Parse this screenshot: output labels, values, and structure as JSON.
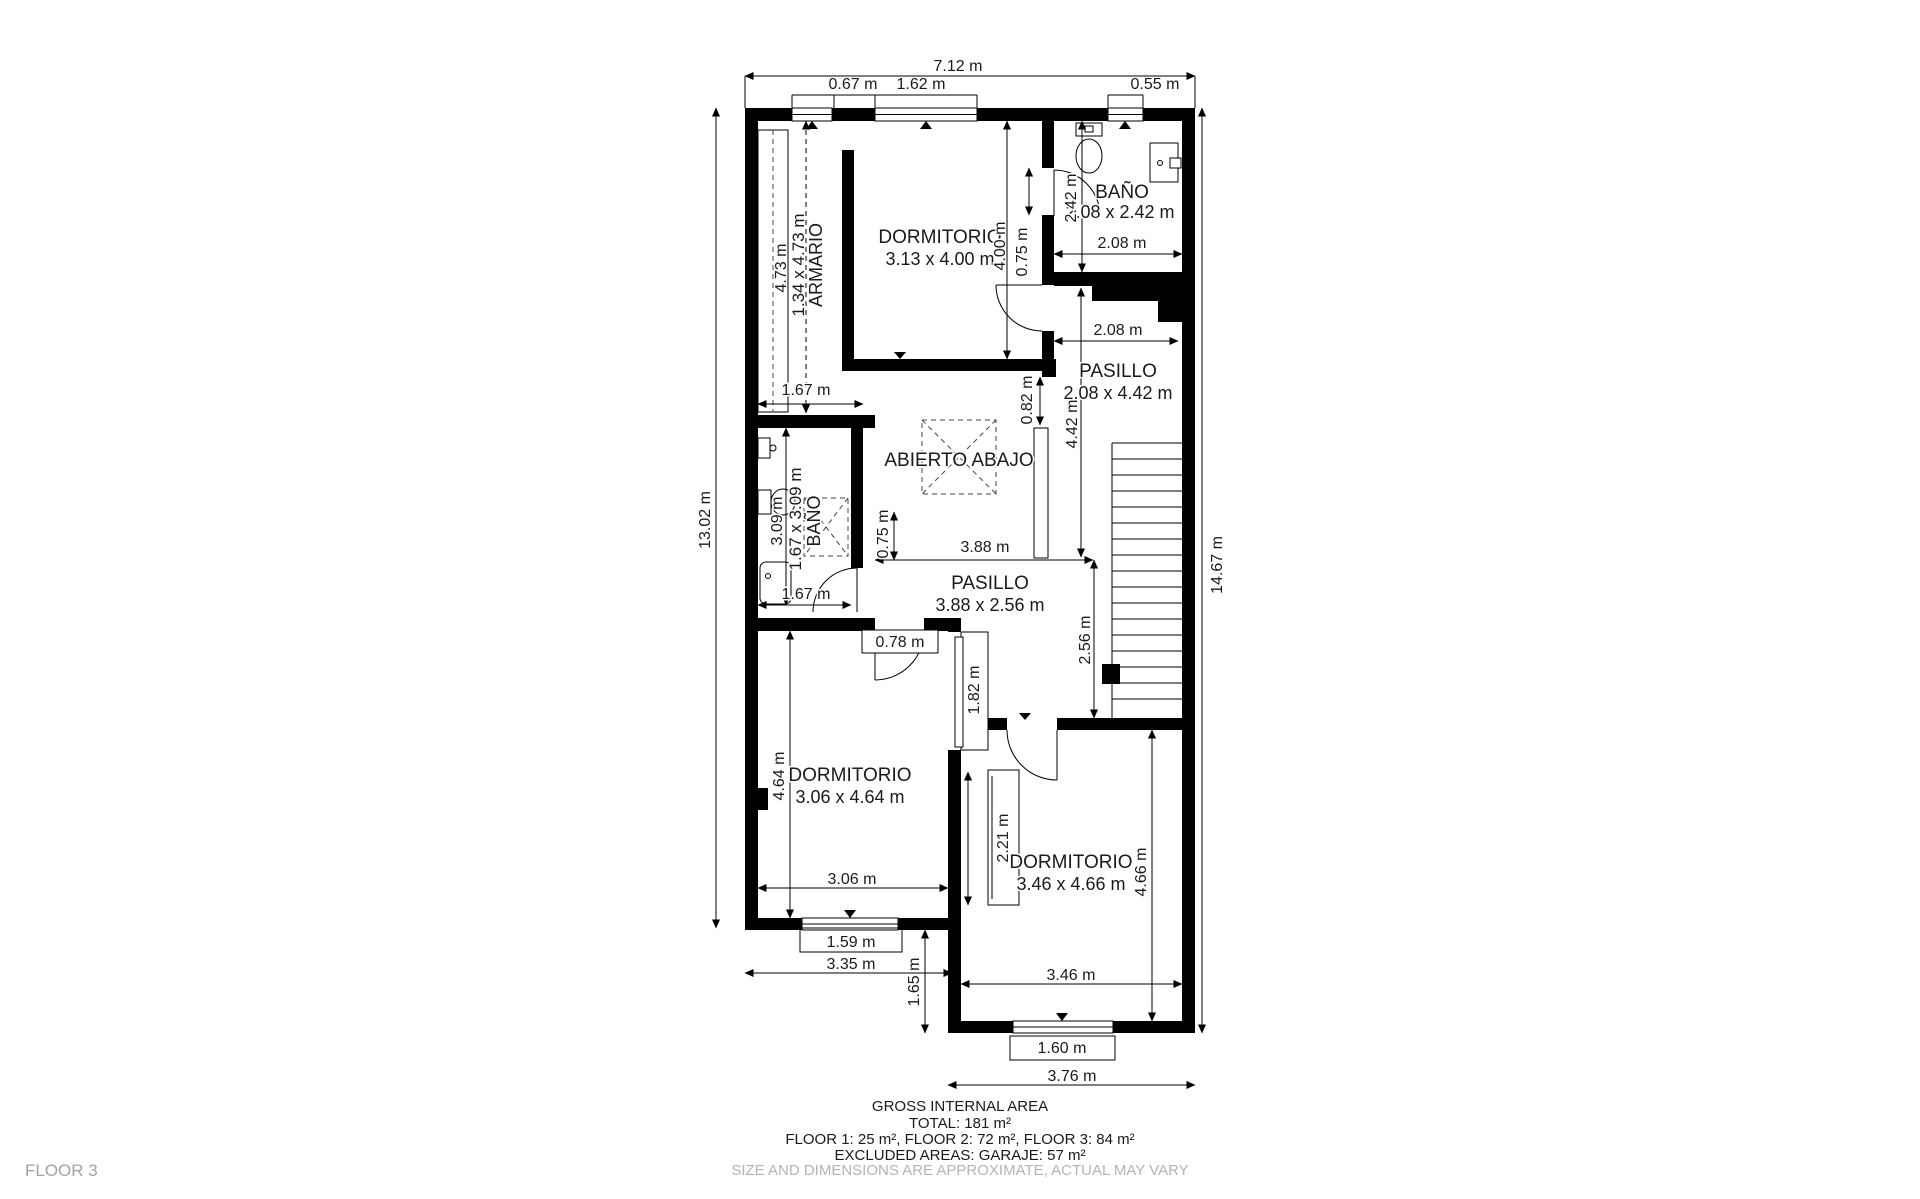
{
  "floor_label": "FLOOR 3",
  "rooms": {
    "armario": {
      "name": "ARMARIO",
      "size": "1.34 x 4.73 m"
    },
    "dormitorio_top": {
      "name": "DORMITORIO",
      "size": "3.13 x 4.00 m"
    },
    "bano_top": {
      "name": "BAÑO",
      "size": "2.08 x 2.42 m"
    },
    "pasillo": {
      "name": "PASILLO",
      "size": "2.08 x 4.42 m"
    },
    "abierto": {
      "name": "ABIERTO ABAJO"
    },
    "bano_left": {
      "name": "BAÑO",
      "size": "1.67 x 3.09 m"
    },
    "pasillo_lower": {
      "name": "PASILLO",
      "size": "3.88 x 2.56 m"
    },
    "dormitorio_bl": {
      "name": "DORMITORIO",
      "size": "3.06 x 4.64 m"
    },
    "dormitorio_br": {
      "name": "DORMITORIO",
      "size": "3.46 x 4.66 m"
    }
  },
  "dims": {
    "total_width": "7.12 m",
    "win_left": "0.67 m",
    "win_mid": "1.62 m",
    "win_right": "0.55 m",
    "height_left": "13.02 m",
    "height_right": "14.67 m",
    "armario_h": "4.73 m",
    "dorm_top_h": "4.00 m",
    "door_top": "0.75 m",
    "bano_top_h": "2.42 m",
    "bano_top_w": "2.08 m",
    "pasillo_w": "2.08 m",
    "pasillo_h": "4.42 m",
    "offset_082": "0.82 m",
    "vest_w": "1.67 m",
    "bano_left_h": "3.09 m",
    "bano_left_w": "1.67 m",
    "pass_075": "0.75 m",
    "pasillo_lower_w": "3.88 m",
    "pasillo_lower_h": "2.56 m",
    "door_bl": "0.78 m",
    "slide_1": "1.82 m",
    "dorm_bl_h": "4.64 m",
    "dorm_bl_w": "3.06 m",
    "slide_2": "2.21 m",
    "dorm_br_h": "4.66 m",
    "dorm_br_w": "3.46 m",
    "win_bl": "1.59 m",
    "sect_left_w": "3.35 m",
    "offset_165": "1.65 m",
    "win_br": "1.60 m",
    "sect_right_w": "3.76 m"
  },
  "footer": {
    "title": "GROSS INTERNAL AREA",
    "total": "TOTAL: 181 m²",
    "floors": "FLOOR 1: 25 m², FLOOR 2: 72 m², FLOOR 3: 84 m²",
    "excluded": "EXCLUDED AREAS: GARAJE: 57 m²",
    "disclaimer": "SIZE AND DIMENSIONS ARE APPROXIMATE, ACTUAL MAY VARY"
  }
}
